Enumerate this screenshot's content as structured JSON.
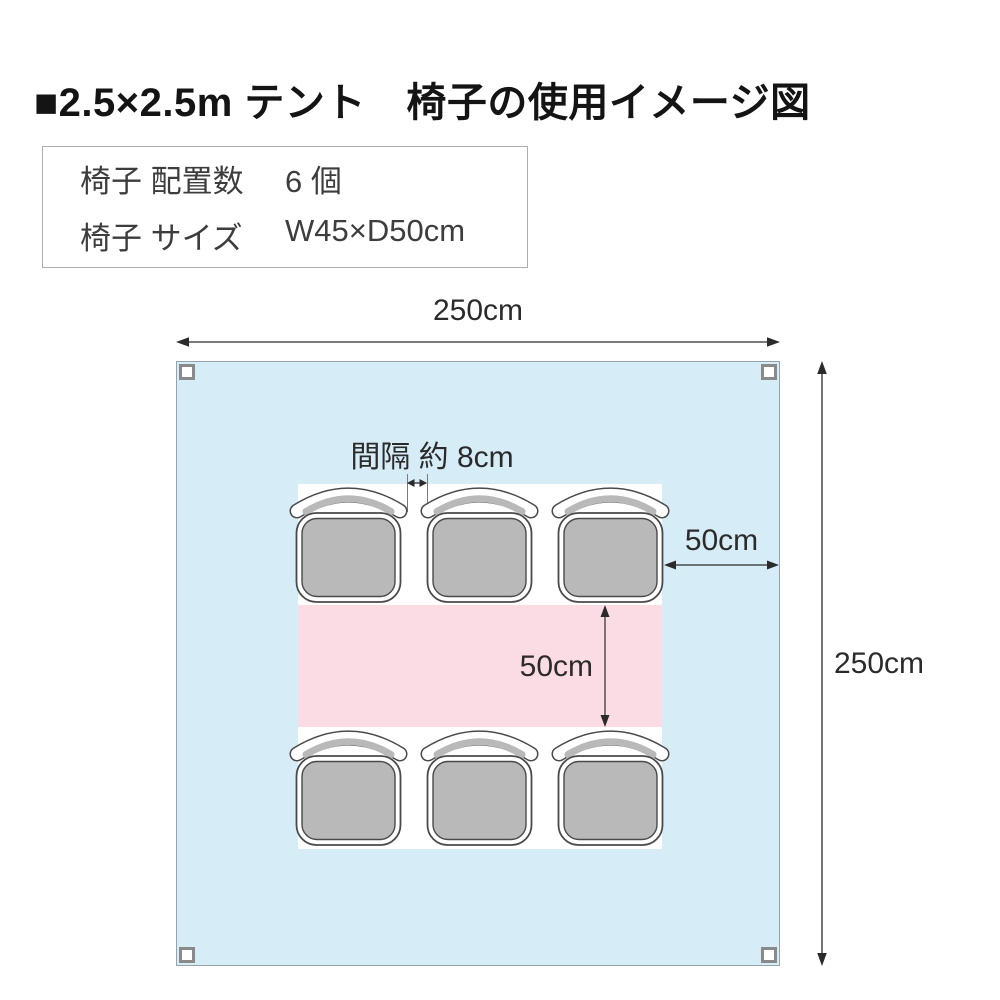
{
  "header": {
    "title": "■2.5×2.5m テント　椅子の使用イメージ図"
  },
  "spec_box": {
    "rows": [
      {
        "label": "椅子 配置数",
        "value": "6 個"
      },
      {
        "label": "椅子 サイズ",
        "value": "W45×D50cm"
      }
    ]
  },
  "diagram": {
    "tent_width_label": "250cm",
    "tent_height_label": "250cm",
    "chair_gap_label": "間隔 約 8cm",
    "side_gap_label": "50cm",
    "row_gap_label": "50cm",
    "chair_count": 6,
    "colors": {
      "tent_fill": "#d6ecf6",
      "aisle_fill": "#fbdce5",
      "chair_fill": "#b9b9b9",
      "chair_outline": "#4a4a4a"
    }
  }
}
